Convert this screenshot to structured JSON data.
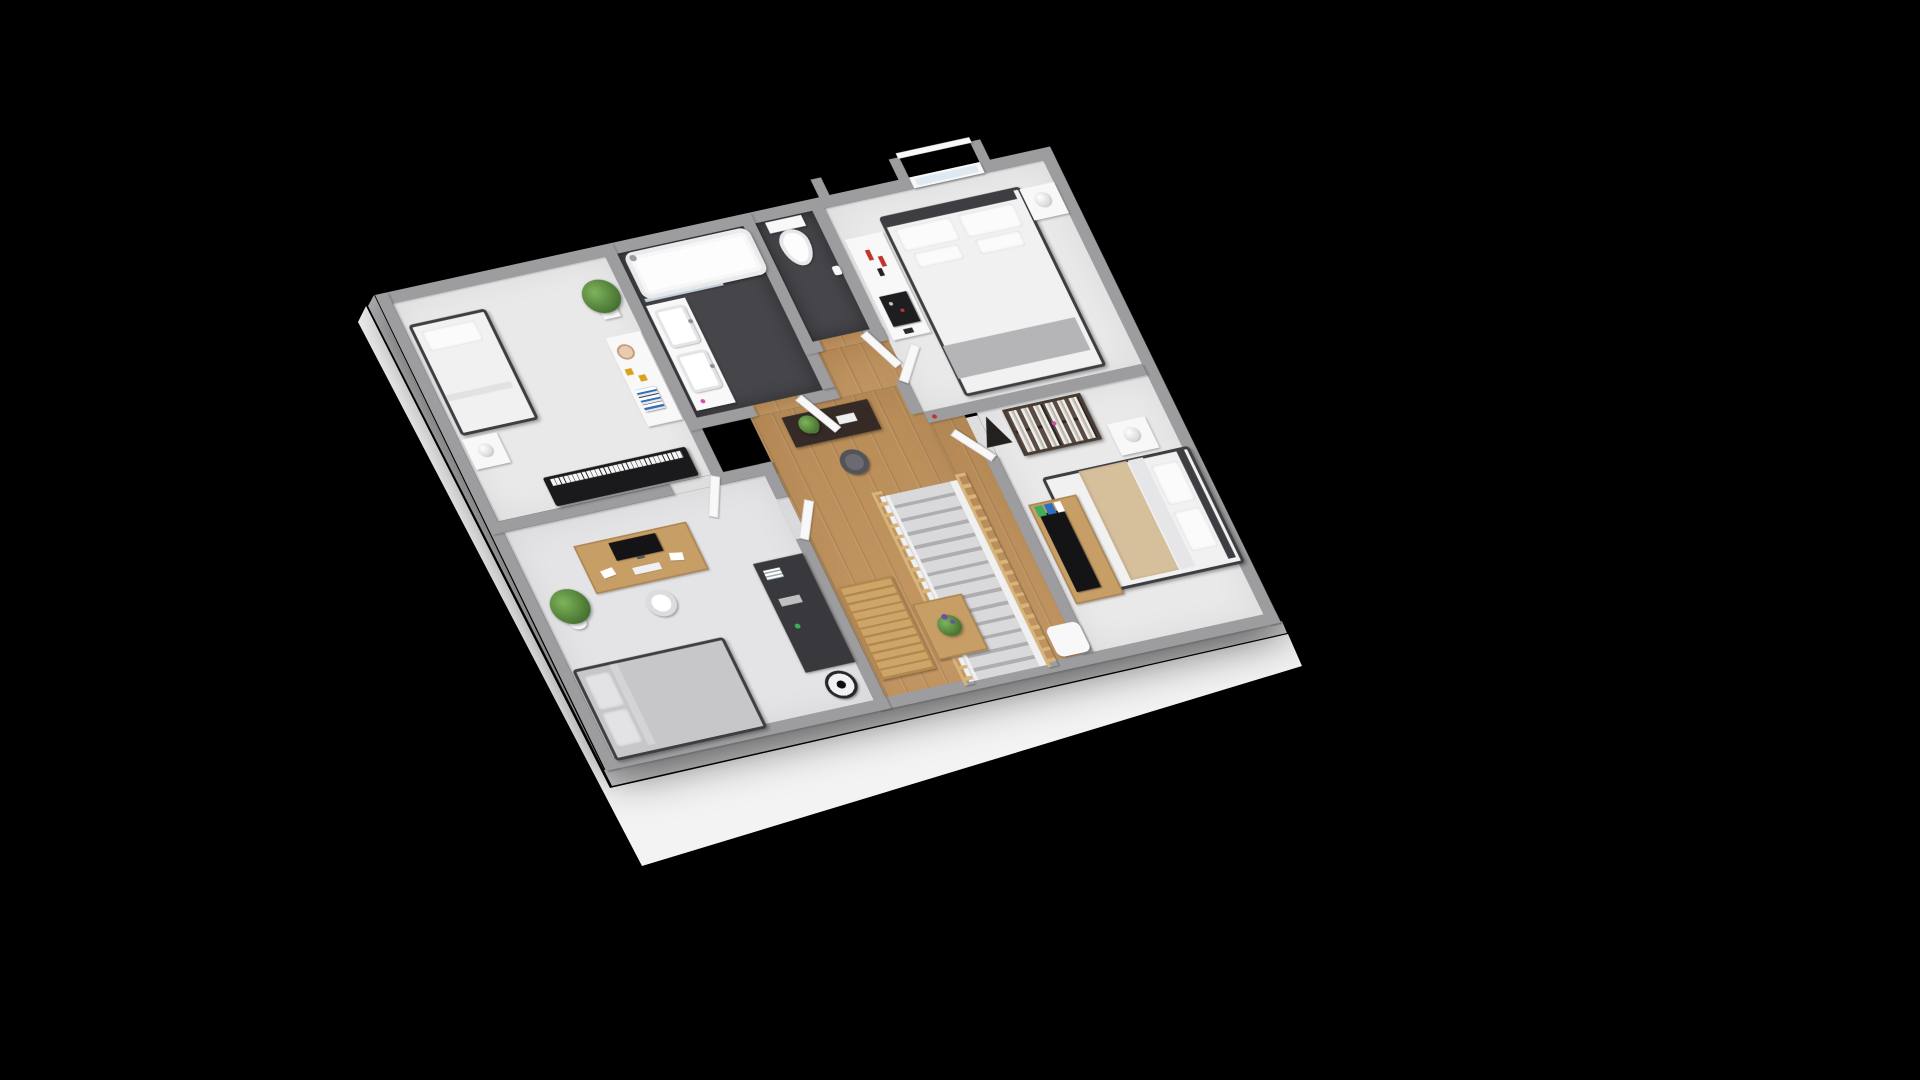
{
  "scene": {
    "description": "3D axonometric rendering of an upper-floor house plan on a black background, with grey walls, light grey carpeted bedrooms, a dark-tiled bathroom and WC, a wooden landing with a staircase, and fully furnished rooms",
    "projection": "axonometric",
    "background": "#000000"
  },
  "palette": {
    "bg": "#000000",
    "slab": "#f3f3f4",
    "wallTop": "#9d9da0",
    "wallFaceW": "#b6b6b8",
    "wallFaceS": "#c9c9cb",
    "carpet": "#e9e9ea",
    "carpet2": "#e4e4e6",
    "bathFloor": "#45454a",
    "wood": "#c2935c",
    "white": "#f8f8f9",
    "duvet": "#f1f1f2",
    "pillow": "#fbfbfc",
    "bedFrame": "#3e3e42",
    "grayThrow": "#b5b5b8",
    "beigeThrow": "#d6c09b",
    "piano": "#1a1a1c",
    "keys": "#f5f5f5",
    "shelf": "#473b34",
    "rail": "#d7b47a",
    "tread": "#d9d9db",
    "treadDark": "#aeaeb1",
    "stringer": "#f0f0f1",
    "woodFurn": "#c79f66",
    "darkFurn": "#39393d",
    "tv": "#141416",
    "red": "#bf352c",
    "glass": "#dfe9f2",
    "plantA": "#7fb35c",
    "plantB": "#45712f",
    "purple": "#6a51a5",
    "chair": "#53535a",
    "lamp": "#ececee",
    "yellow": "#d9a21a",
    "bookBlue": "#2f6fbe",
    "bookGreen": "#3fae5a",
    "pink": "#d14fb0",
    "trayDark": "#1e1e20",
    "gray4": "#c7c7c9"
  },
  "rooms": [
    {
      "id": "bedroom-top-left",
      "floor_material": "light-grey-carpet",
      "items": [
        "single-bed",
        "pillow",
        "nightstand",
        "ball-table-lamp",
        "digital-piano",
        "dresser",
        "decor-plate",
        "picture-frames",
        "book-stack",
        "tall-grass-plant"
      ]
    },
    {
      "id": "bathroom",
      "floor_material": "dark-charcoal-tile",
      "items": [
        "bathtub",
        "shower-head",
        "glass-shower-screen",
        "double-sink-vanity",
        "toothbrush-cup",
        "open-door"
      ]
    },
    {
      "id": "wc",
      "floor_material": "dark-charcoal-tile",
      "items": [
        "toilet",
        "toilet-paper-roll",
        "open-door"
      ]
    },
    {
      "id": "master-bedroom",
      "floor_material": "light-grey-carpet",
      "items": [
        "double-bed",
        "pillows",
        "grey-bed-runner",
        "window-with-alcove",
        "candle-sideboard",
        "red-candles",
        "black-tray-with-bottles",
        "nightstand",
        "ball-table-lamp",
        "open-door"
      ]
    },
    {
      "id": "bedroom-right",
      "floor_material": "light-grey-carpet",
      "items": [
        "double-bed-with-beige-throw",
        "pillows",
        "nightstand",
        "ball-table-lamp",
        "desk-with-tv-panel",
        "colorful-books",
        "bookshelf-with-books",
        "a-frame-decor",
        "open-door"
      ]
    },
    {
      "id": "hallway-landing",
      "floor_material": "oak-wood-planks",
      "items": [
        "staircase",
        "wooden-railings",
        "console-table",
        "potted-plant",
        "swivel-chair",
        "slatted-wood-bench",
        "coffee-table",
        "flower-basket",
        "white-stool",
        "door-stopper"
      ]
    },
    {
      "id": "bedroom-bottom-left",
      "floor_material": "light-grey-carpet",
      "items": [
        "desk",
        "computer-monitor",
        "keyboard",
        "papers",
        "desk-chair",
        "bushy-potted-plant",
        "floor-lamp",
        "grey-bed",
        "storage-sideboard",
        "books-decor",
        "pedestal-fan",
        "open-door"
      ]
    }
  ],
  "structure": {
    "outer_walls": "grey",
    "inner_walls": "grey-top-white-face",
    "foreground_slab": "white",
    "doors_count": 6,
    "window_count": 1
  }
}
